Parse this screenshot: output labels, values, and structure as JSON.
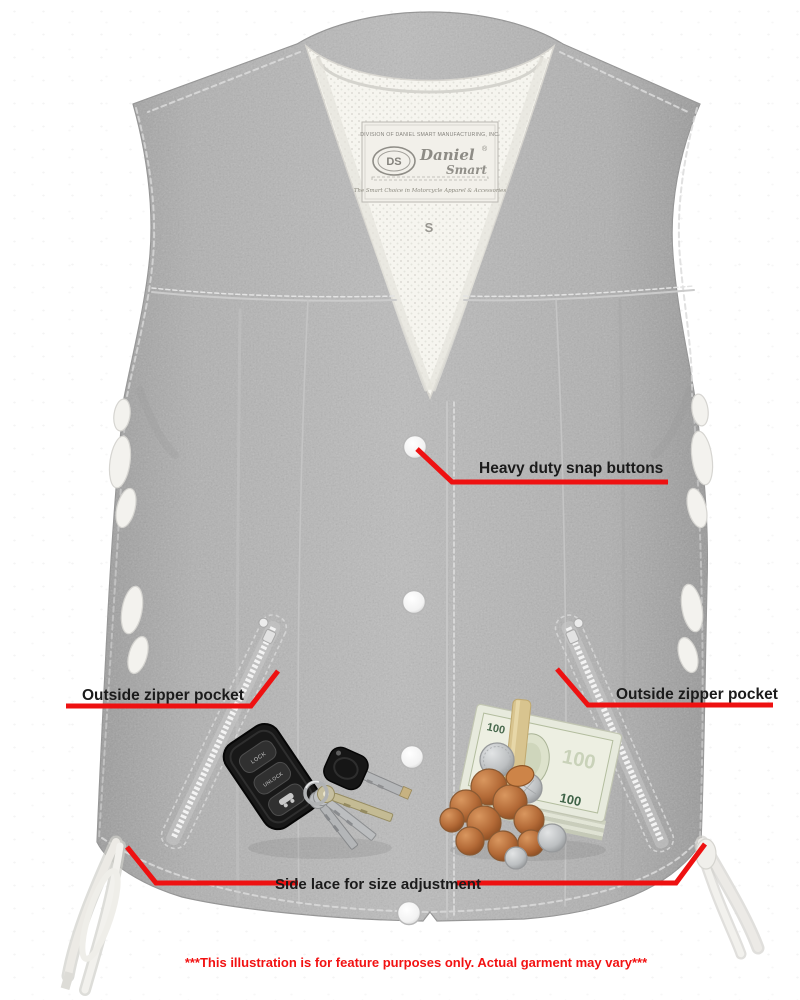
{
  "page": {
    "background_color": "#ffffff",
    "disclaimer": "***This illustration is for feature purposes only. Actual garment may vary***",
    "disclaimer_color": "#f21212"
  },
  "vest": {
    "garment": "gray denim motorcycle vest, front view, white mesh lining",
    "denim_color": "#b2b2b2",
    "lining_color": "#f6f5ef",
    "size_tag": "S",
    "snap_count": 4,
    "label": {
      "division_line": "DIVISION OF DANIEL SMART MANUFACTURING, INC.",
      "monogram": "DS",
      "brand_line1": "Daniel",
      "brand_line2": "Smart",
      "registered": "®",
      "tagline": "The Smart Choice in Motorcycle Apparel & Accessories"
    }
  },
  "callouts": {
    "line_color": "#ee1111",
    "snap_buttons": "Heavy duty snap buttons",
    "left_pocket": "Outside zipper pocket",
    "right_pocket": "Outside zipper pocket",
    "side_lace": "Side lace for size adjustment"
  },
  "props": {
    "keys": {
      "fob_button_1": "LOCK",
      "fob_button_2": "UNLOCK"
    },
    "money": {
      "bill_value": "100"
    }
  }
}
